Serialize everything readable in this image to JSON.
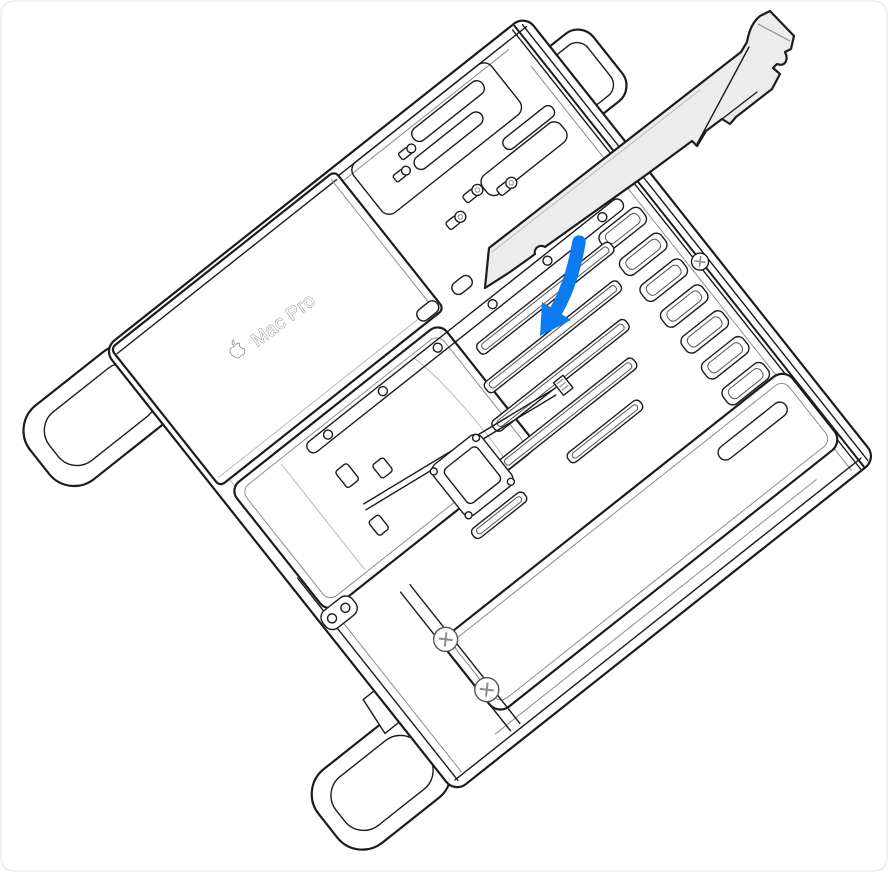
{
  "figure": {
    "device_label": "Mac Pro",
    "caption_hint": ""
  },
  "colors": {
    "background": "#ffffff",
    "outline": "#1c1c1c",
    "outline_light": "#8c8c8c",
    "card_fill": "#ececec",
    "arrow": "#0b7bf0",
    "label_stroke": "#8a8a8a"
  },
  "icons": {
    "apple_logo_icon": "apple",
    "insertion_arrow_icon": "arrow-down-into-slot"
  }
}
